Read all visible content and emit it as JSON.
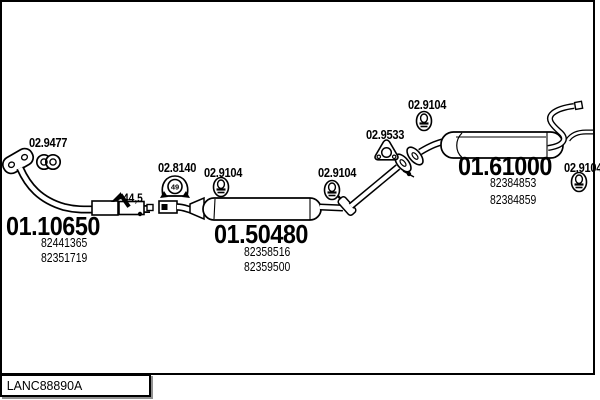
{
  "page": {
    "background": "#ffffff",
    "line_color": "#000000",
    "shadow_color": "#909090"
  },
  "footer": {
    "catalog_code": "LANC88890A"
  },
  "sections": {
    "front_pipe": {
      "code": "01.10650",
      "part_numbers": [
        "82441365",
        "82351719"
      ]
    },
    "center_muffler": {
      "code": "01.50480",
      "part_numbers": [
        "82358516",
        "82359500"
      ]
    },
    "rear_muffler": {
      "code": "01.61000",
      "part_numbers": [
        "82384853",
        "82384859"
      ]
    }
  },
  "accessories": {
    "clamp": {
      "code": "02.9477",
      "icon": "double-ring-clamp"
    },
    "rubber_mount": {
      "code": "02.8140",
      "icon": "arch-rubber-mount",
      "mount_mark": "49"
    },
    "gasket": {
      "code": "02.9533",
      "icon": "triangular-gasket"
    },
    "hanger_rings": [
      {
        "code": "02.9104"
      },
      {
        "code": "02.9104"
      },
      {
        "code": "02.9104"
      },
      {
        "code": "02.9104"
      }
    ]
  },
  "dimensions": {
    "pipe_diameter": "44,5"
  }
}
